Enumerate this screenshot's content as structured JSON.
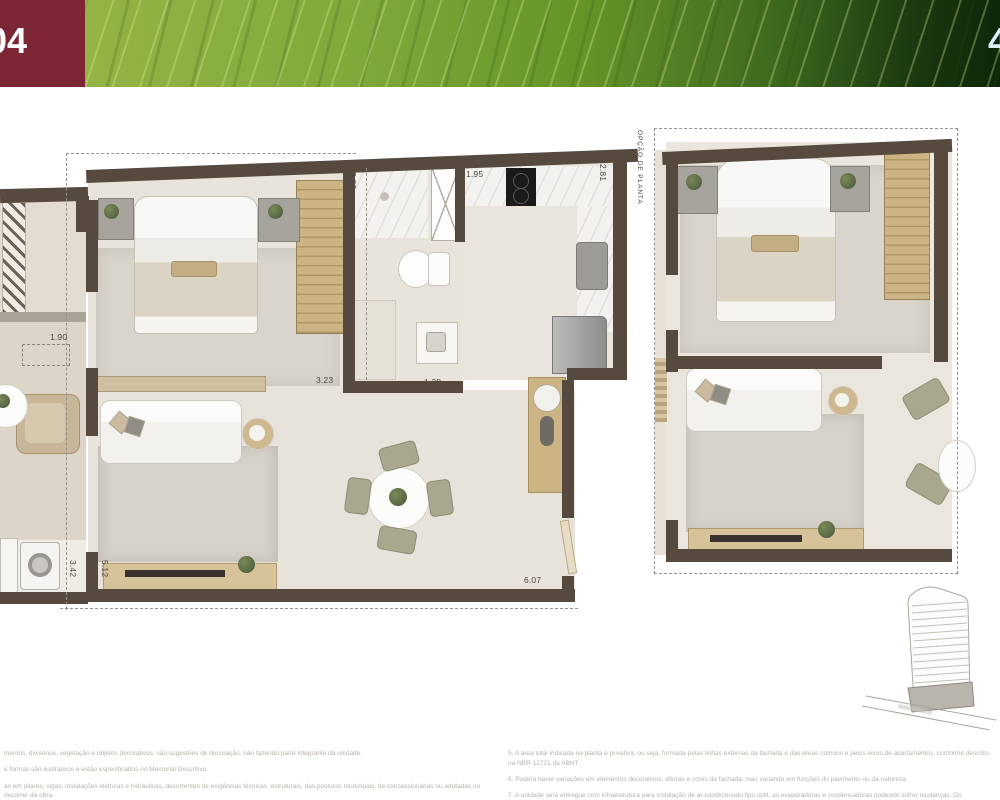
{
  "header": {
    "unit_number": "04",
    "corner_number": "4"
  },
  "plan_main": {
    "dimensions": {
      "balcony_width": "1.90",
      "bath_depth": "2.80",
      "bedroom_width": "3.23",
      "bath_width": "1.38",
      "kitchen_width": "1.95",
      "kitchen_depth": "2.81",
      "laundry_width": "3.42",
      "living_width": "5.12",
      "living_length": "6.07"
    }
  },
  "plan_option": {
    "label": "OPÇÃO DE PLANTA"
  },
  "footer": {
    "left_notes": [
      "mentos, divisórios, vegetação e objetos decorativos, são sugestões de decoração, não fazendo parte integrante da unidade.",
      "e formas são ilustrativos e estão especificados no Memorial Descritivo.",
      "as em pilares, vigas, instalações elétricas e hidráulicas, decorrentes de exigências técnicas, estruturais, das posturas municipais, de concessionárias ou adotadas no decorrer da obra."
    ],
    "right_notes": [
      "5. A área total indicada na planta é privativa, ou seja, formada pelas linhas externas da fachada e das áreas comuns e pelos eixos de apartamentos, conforme descrito na NBR 12721 da ABNT.",
      "6. Poderá haver variações em elementos decorativos, alturas e cores da fachada, mas variando em funções do pavimento ou da natureza.",
      "7. A unidade será entregue com infraestrutura para instalação de ar-condicionado tipo split, as evaporadoras e condensadoras podendo sofrer mudanças. Os condensadores ficarão na varanda das unidades frontais e nos vãos de alvenaria na fachada de fundos."
    ]
  },
  "colors": {
    "brand": "#7c2535",
    "leaf_green": "#7da237",
    "wall": "#564a3e"
  }
}
